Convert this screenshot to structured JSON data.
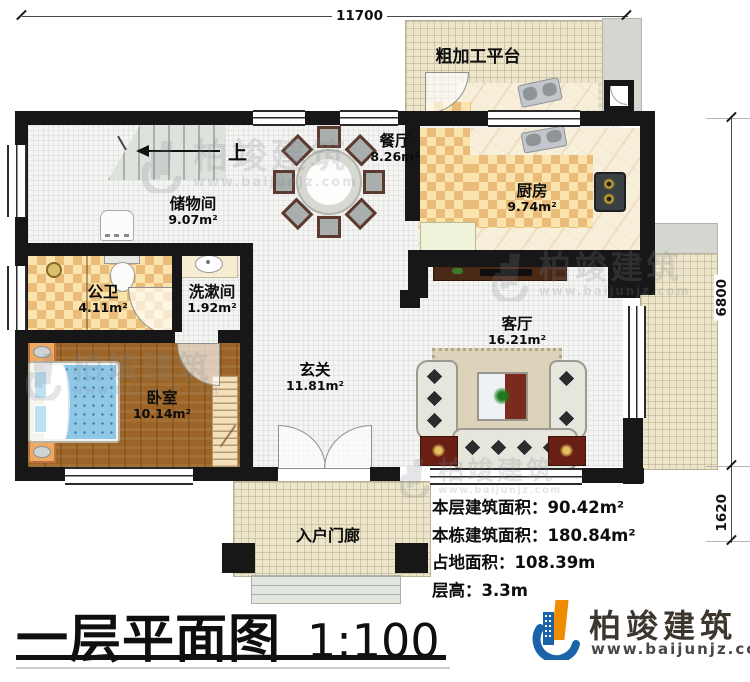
{
  "title": {
    "main": "一层平面图",
    "scale": "1:100"
  },
  "dimensions": {
    "top": "11700",
    "right_upper": "6800",
    "right_lower": "1620"
  },
  "stairs": {
    "up_label": "上"
  },
  "rooms": {
    "storage": {
      "name": "储物间",
      "area": "9.07m²"
    },
    "dining": {
      "name": "餐厅",
      "area": "8.26m²"
    },
    "kitchen": {
      "name": "厨房",
      "area": "9.74m²"
    },
    "public_bath": {
      "name": "公卫",
      "area": "4.11m²"
    },
    "washroom": {
      "name": "洗漱间",
      "area": "1.92m²"
    },
    "bedroom": {
      "name": "卧室",
      "area": "10.14m²"
    },
    "foyer": {
      "name": "玄关",
      "area": "11.81m²"
    },
    "living": {
      "name": "客厅",
      "area": "16.21m²"
    },
    "platform": {
      "name": "粗加工平台",
      "area": ""
    },
    "porch": {
      "name": "入户门廊",
      "area": ""
    }
  },
  "info": {
    "floor_area_label": "本层建筑面积：",
    "floor_area_value": "90.42m²",
    "building_area_label": "本栋建筑面积：",
    "building_area_value": "180.84m²",
    "footprint_label": "占地面积：",
    "footprint_value": "108.39m",
    "storey_height_label": "层高：",
    "storey_height_value": "3.3m"
  },
  "logo": {
    "name": "柏竣建筑",
    "url": "www.baijunjz.com"
  },
  "watermark": {
    "text": "柏竣建筑",
    "url": "www.baijunjz.com"
  },
  "colors": {
    "wall": "#171717",
    "counter_checker": "#e9bd79",
    "wood_floor": "#9c6527",
    "bed_blue": "#8fc8e6",
    "logo_blue": "#1b63a8",
    "logo_orange": "#f08c00"
  }
}
